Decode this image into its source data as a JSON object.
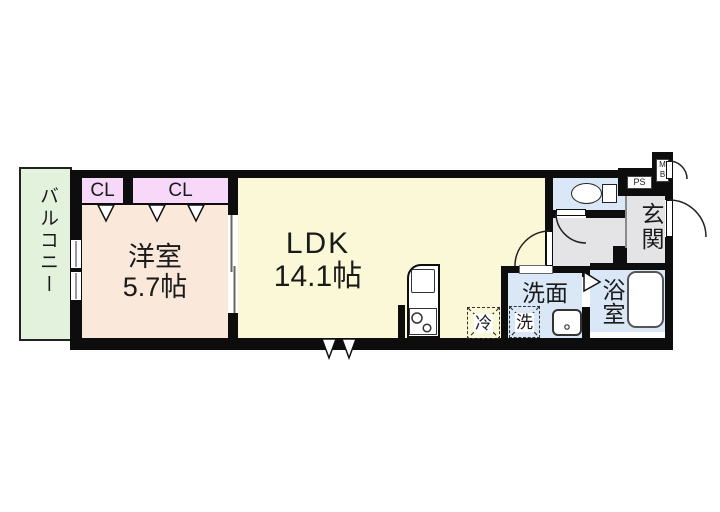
{
  "plan": {
    "rooms": {
      "balcony": {
        "label": "バルコニー"
      },
      "western_room": {
        "label": "洋室",
        "size": "5.7帖"
      },
      "closet_left": {
        "label": "CL"
      },
      "closet_right": {
        "label": "CL"
      },
      "ldk": {
        "label": "LDK",
        "size": "14.1帖"
      },
      "entrance": {
        "label": "玄関"
      },
      "washroom": {
        "label": "洗面"
      },
      "bathroom": {
        "label": "浴室"
      }
    },
    "fixtures": {
      "pipe_space": {
        "label": "PS"
      },
      "meter_box": {
        "label": "MB",
        "line1": "M",
        "line2": "B"
      },
      "refrigerator_space": {
        "label": "冷"
      },
      "washer_space": {
        "label": "洗"
      }
    },
    "colors": {
      "wall": "#0d0d0d",
      "balcony": "#e2f2dd",
      "western_room": "#fae8da",
      "closet": "#f8d8f8",
      "ldk": "#fbf8d8",
      "wet_area": "#d9e7f6",
      "hall": "#e4e4e7",
      "background": "#ffffff"
    }
  }
}
